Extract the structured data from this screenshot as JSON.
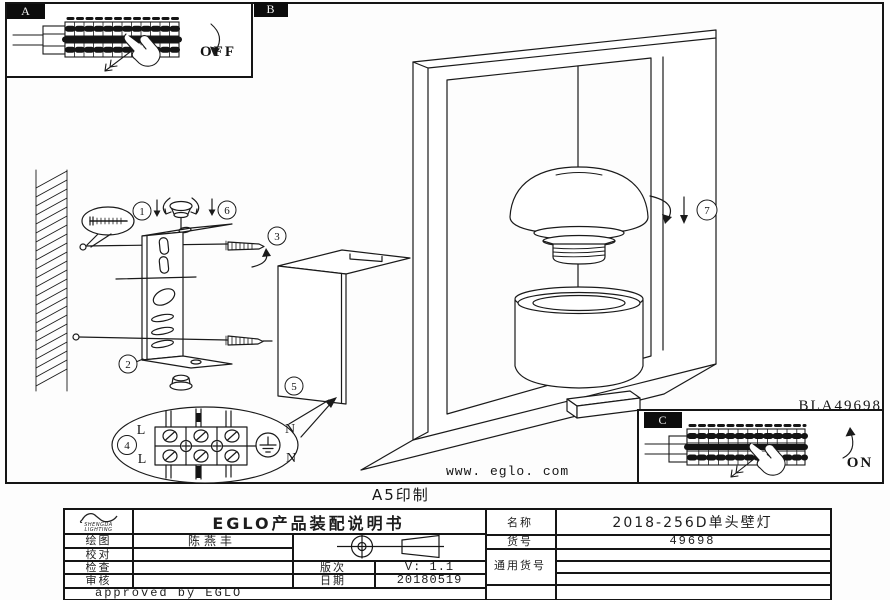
{
  "page": {
    "model_code": "BLA49698",
    "website": "www. eglo. com",
    "print_note": "A5印制"
  },
  "panels": {
    "a": {
      "label": "A",
      "state": "OFF"
    },
    "b": {
      "label": "B"
    },
    "c": {
      "label": "C",
      "state": "ON"
    }
  },
  "callouts": {
    "n1": "1",
    "n2": "2",
    "n3": "3",
    "n4": "4",
    "n5": "5",
    "n6": "6",
    "n7": "7"
  },
  "terminal": {
    "l_top": "L",
    "l_bottom": "L",
    "n_top": "N",
    "n_bottom": "N"
  },
  "title_block": {
    "logo": {
      "line1": "SHENGDA",
      "line2": "LIGHTING"
    },
    "doc_title": "EGLO产品装配说明书",
    "labels": {
      "draw": "绘图",
      "proof": "校对",
      "check": "检查",
      "audit": "审核",
      "version": "版次",
      "date": "日期",
      "name": "名称",
      "item": "货号",
      "common": "通用货号"
    },
    "values": {
      "draw": "陈燕丰",
      "version": "V: 1.1",
      "date": "20180519",
      "name": "2018-256D单头壁灯",
      "item": "49698"
    },
    "approved": "approved by EGLO"
  }
}
